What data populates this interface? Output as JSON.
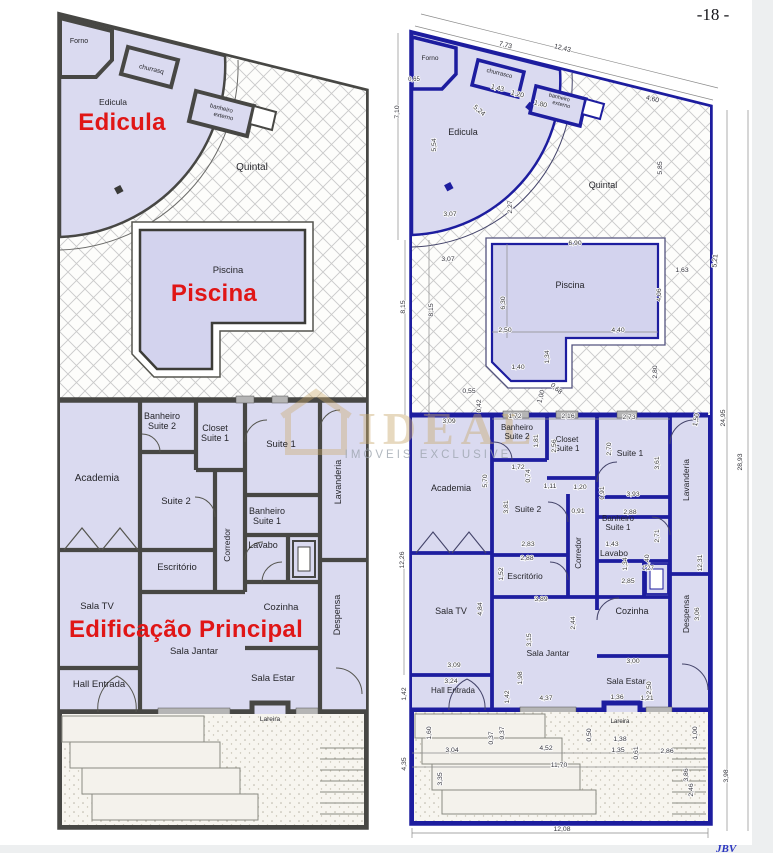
{
  "page": {
    "number_label": "-18 -",
    "footer_logo": "JBV"
  },
  "colors": {
    "red_title": "#e01616",
    "navy_wall": "#1d1d9f",
    "gray_wall": "#474744",
    "lavender_fill": "#dadaf0",
    "pool_fill": "#d3d3ee",
    "hatch_line": "#c9c9c9",
    "watermark_gold": "#c9a96e",
    "watermark_gray": "#9aa2ab"
  },
  "watermark": {
    "brand": "IDEAL",
    "sub": "IMÓVEIS EXCLUSIVE"
  },
  "left_plan": {
    "titles": [
      {
        "t": "Edicula",
        "x": 122,
        "y": 130
      },
      {
        "t": "Piscina",
        "x": 214,
        "y": 301
      },
      {
        "t": "Edificação Principal",
        "x": 186,
        "y": 637
      }
    ],
    "rooms": [
      {
        "t": "Forno",
        "x": 79,
        "y": 43,
        "s": 7
      },
      {
        "t": "churrasq",
        "x": 151,
        "y": 71,
        "r": 14,
        "s": 6.5
      },
      {
        "t": "banheiro",
        "x": 221,
        "y": 110,
        "r": 14,
        "s": 6
      },
      {
        "t": "externo",
        "x": 223,
        "y": 118,
        "r": 14,
        "s": 6
      },
      {
        "t": "Edicula",
        "x": 113,
        "y": 105,
        "s": 8.5
      },
      {
        "t": "Quintal",
        "x": 252,
        "y": 170,
        "s": 10
      },
      {
        "t": "Piscina",
        "x": 228,
        "y": 273,
        "s": 9.5
      },
      {
        "t": "Banheiro",
        "x": 162,
        "y": 419,
        "s": 9
      },
      {
        "t": "Suite 2",
        "x": 162,
        "y": 429,
        "s": 9
      },
      {
        "t": "Closet",
        "x": 215,
        "y": 431,
        "s": 9
      },
      {
        "t": "Suite 1",
        "x": 215,
        "y": 441,
        "s": 9
      },
      {
        "t": "Suite 1",
        "x": 281,
        "y": 447,
        "s": 9.5
      },
      {
        "t": "Academia",
        "x": 97,
        "y": 481,
        "s": 10
      },
      {
        "t": "Suite 2",
        "x": 176,
        "y": 504,
        "s": 9.5
      },
      {
        "t": "Banheiro",
        "x": 267,
        "y": 514,
        "s": 9
      },
      {
        "t": "Suite 1",
        "x": 267,
        "y": 524,
        "s": 9
      },
      {
        "t": "Lavanderia",
        "x": 341,
        "y": 482,
        "r": -90,
        "s": 9
      },
      {
        "t": "Corredor",
        "x": 230,
        "y": 545,
        "r": -90,
        "s": 8.5
      },
      {
        "t": "Lavabo",
        "x": 263,
        "y": 548,
        "s": 9
      },
      {
        "t": "Escritório",
        "x": 177,
        "y": 570,
        "s": 9.5
      },
      {
        "t": "Sala TV",
        "x": 97,
        "y": 609,
        "s": 9.5
      },
      {
        "t": "Cozinha",
        "x": 281,
        "y": 610,
        "s": 9.5
      },
      {
        "t": "Despensa",
        "x": 340,
        "y": 615,
        "r": -90,
        "s": 9
      },
      {
        "t": "Sala Jantar",
        "x": 194,
        "y": 654,
        "s": 9.5
      },
      {
        "t": "Sala Estar",
        "x": 273,
        "y": 681,
        "s": 9.5
      },
      {
        "t": "Hall Entrada",
        "x": 99,
        "y": 687,
        "s": 9.5
      },
      {
        "t": "Lareira",
        "x": 270,
        "y": 721,
        "s": 6.5
      }
    ]
  },
  "right_plan": {
    "rooms": [
      {
        "t": "Forno",
        "x": 430,
        "y": 60,
        "s": 6.5
      },
      {
        "t": "churrasco",
        "x": 499,
        "y": 75,
        "r": 14,
        "s": 6
      },
      {
        "t": "banheiro",
        "x": 559,
        "y": 99,
        "r": 14,
        "s": 5.5
      },
      {
        "t": "externo",
        "x": 561,
        "y": 106,
        "r": 14,
        "s": 5.5
      },
      {
        "t": "Edicula",
        "x": 463,
        "y": 135,
        "s": 9
      },
      {
        "t": "Quintal",
        "x": 603,
        "y": 188,
        "s": 9
      },
      {
        "t": "Piscina",
        "x": 570,
        "y": 288,
        "s": 9
      },
      {
        "t": "Banheiro",
        "x": 517,
        "y": 430,
        "s": 8
      },
      {
        "t": "Suite 2",
        "x": 517,
        "y": 439,
        "s": 8
      },
      {
        "t": "Closet",
        "x": 567,
        "y": 442,
        "s": 8
      },
      {
        "t": "Suite 1",
        "x": 567,
        "y": 451,
        "s": 8
      },
      {
        "t": "Suite 1",
        "x": 630,
        "y": 456,
        "s": 8.5
      },
      {
        "t": "Academia",
        "x": 451,
        "y": 491,
        "s": 9
      },
      {
        "t": "Suite 2",
        "x": 528,
        "y": 512,
        "s": 8.5
      },
      {
        "t": "Banheiro",
        "x": 618,
        "y": 521,
        "s": 8
      },
      {
        "t": "Suite 1",
        "x": 618,
        "y": 530,
        "s": 8
      },
      {
        "t": "Lavanderia",
        "x": 689,
        "y": 480,
        "r": -90,
        "s": 8.5
      },
      {
        "t": "Corredor",
        "x": 581,
        "y": 553,
        "r": -90,
        "s": 8
      },
      {
        "t": "Lavabo",
        "x": 614,
        "y": 556,
        "s": 8.5
      },
      {
        "t": "Escritório",
        "x": 525,
        "y": 579,
        "s": 8.5
      },
      {
        "t": "Sala TV",
        "x": 451,
        "y": 614,
        "s": 9
      },
      {
        "t": "Cozinha",
        "x": 632,
        "y": 614,
        "s": 9
      },
      {
        "t": "Despensa",
        "x": 689,
        "y": 614,
        "r": -90,
        "s": 8.5
      },
      {
        "t": "Sala Jantar",
        "x": 548,
        "y": 656,
        "s": 8.5
      },
      {
        "t": "Sala Estar",
        "x": 626,
        "y": 684,
        "s": 8.5
      },
      {
        "t": "Hall Entrada",
        "x": 453,
        "y": 693,
        "s": 8
      },
      {
        "t": "Lareira",
        "x": 620,
        "y": 723,
        "s": 6
      }
    ],
    "dims": [
      {
        "t": "7,73",
        "x": 505,
        "y": 47,
        "r": 14
      },
      {
        "t": "12,43",
        "x": 562,
        "y": 50,
        "r": 14
      },
      {
        "t": "0,65",
        "x": 414,
        "y": 81,
        "s": 6
      },
      {
        "t": "1,43",
        "x": 497,
        "y": 90,
        "r": 14
      },
      {
        "t": "1,20",
        "x": 517,
        "y": 96,
        "r": 14
      },
      {
        "t": "1,80",
        "x": 540,
        "y": 106,
        "r": 14
      },
      {
        "t": "4,60",
        "x": 652,
        "y": 101,
        "r": 14
      },
      {
        "t": "7,10",
        "x": 399,
        "y": 112,
        "r": -90
      },
      {
        "t": "5,54",
        "x": 436,
        "y": 145,
        "r": -90
      },
      {
        "t": "5,24",
        "x": 478,
        "y": 112,
        "r": 40
      },
      {
        "t": "5,85",
        "x": 662,
        "y": 168,
        "r": -90
      },
      {
        "t": "2,27",
        "x": 512,
        "y": 207,
        "r": -90
      },
      {
        "t": "3,07",
        "x": 450,
        "y": 216
      },
      {
        "t": "6,90",
        "x": 575,
        "y": 245
      },
      {
        "t": "3,07",
        "x": 448,
        "y": 261
      },
      {
        "t": "1,63",
        "x": 682,
        "y": 272
      },
      {
        "t": "5,21",
        "x": 717,
        "y": 261,
        "r": -85
      },
      {
        "t": "6,30",
        "x": 505,
        "y": 303,
        "r": -90
      },
      {
        "t": "4,06",
        "x": 661,
        "y": 295,
        "r": -90
      },
      {
        "t": "8,15",
        "x": 405,
        "y": 307,
        "r": -90
      },
      {
        "t": "8,15",
        "x": 433,
        "y": 310,
        "r": -90
      },
      {
        "t": "2,50",
        "x": 505,
        "y": 332
      },
      {
        "t": "4,40",
        "x": 618,
        "y": 332
      },
      {
        "t": "1,40",
        "x": 518,
        "y": 369
      },
      {
        "t": "1,34",
        "x": 549,
        "y": 357,
        "r": -90
      },
      {
        "t": "2,80",
        "x": 657,
        "y": 372,
        "r": -90
      },
      {
        "t": "0,55",
        "x": 469,
        "y": 393
      },
      {
        "t": "0,42",
        "x": 481,
        "y": 406,
        "r": -90
      },
      {
        "t": "1,00",
        "x": 543,
        "y": 397,
        "r": -75
      },
      {
        "t": "0,68",
        "x": 555,
        "y": 390,
        "r": 42
      },
      {
        "t": "24,95",
        "x": 725,
        "y": 418,
        "r": -90
      },
      {
        "t": "28,93",
        "x": 742,
        "y": 462,
        "r": -90
      },
      {
        "t": "3,09",
        "x": 449,
        "y": 423
      },
      {
        "t": "1,72",
        "x": 515,
        "y": 418
      },
      {
        "t": "2,16",
        "x": 568,
        "y": 418
      },
      {
        "t": "2,73",
        "x": 629,
        "y": 419
      },
      {
        "t": "1,50",
        "x": 698,
        "y": 420,
        "r": -80
      },
      {
        "t": "1,81",
        "x": 538,
        "y": 441,
        "r": -90
      },
      {
        "t": "2,56",
        "x": 556,
        "y": 446,
        "r": -90
      },
      {
        "t": "2,70",
        "x": 611,
        "y": 449,
        "r": -90
      },
      {
        "t": "3,61",
        "x": 659,
        "y": 463,
        "r": -90
      },
      {
        "t": "1,72",
        "x": 518,
        "y": 469
      },
      {
        "t": "0,74",
        "x": 530,
        "y": 476,
        "r": -90
      },
      {
        "t": "5,70",
        "x": 487,
        "y": 481,
        "r": -90
      },
      {
        "t": "1,11",
        "x": 550,
        "y": 488
      },
      {
        "t": "1,20",
        "x": 580,
        "y": 489
      },
      {
        "t": "0,91",
        "x": 604,
        "y": 493,
        "r": -90
      },
      {
        "t": "3,93",
        "x": 633,
        "y": 496
      },
      {
        "t": "3,81",
        "x": 508,
        "y": 507,
        "r": -90
      },
      {
        "t": "0,91",
        "x": 578,
        "y": 513
      },
      {
        "t": "2,88",
        "x": 630,
        "y": 514
      },
      {
        "t": "2,71",
        "x": 659,
        "y": 536,
        "r": -90
      },
      {
        "t": "2,83",
        "x": 528,
        "y": 546
      },
      {
        "t": "2,88",
        "x": 527,
        "y": 560
      },
      {
        "t": "1,43",
        "x": 612,
        "y": 546
      },
      {
        "t": "1,40",
        "x": 649,
        "y": 561,
        "r": -90
      },
      {
        "t": "1,34",
        "x": 627,
        "y": 564,
        "r": -90
      },
      {
        "t": "1,27",
        "x": 648,
        "y": 570,
        "s": 6
      },
      {
        "t": "1,52",
        "x": 503,
        "y": 574,
        "r": -90
      },
      {
        "t": "2,85",
        "x": 628,
        "y": 583
      },
      {
        "t": "3,89",
        "x": 541,
        "y": 601
      },
      {
        "t": "4,84",
        "x": 482,
        "y": 609,
        "r": -90
      },
      {
        "t": "12,26",
        "x": 404,
        "y": 560,
        "r": -90
      },
      {
        "t": "2,44",
        "x": 575,
        "y": 623,
        "r": -90
      },
      {
        "t": "3,06",
        "x": 699,
        "y": 614,
        "r": -90
      },
      {
        "t": "12,31",
        "x": 702,
        "y": 563,
        "r": -90
      },
      {
        "t": "3,15",
        "x": 531,
        "y": 640,
        "r": -90
      },
      {
        "t": "1,98",
        "x": 522,
        "y": 678,
        "r": -90
      },
      {
        "t": "3,09",
        "x": 454,
        "y": 667
      },
      {
        "t": "3,00",
        "x": 633,
        "y": 663
      },
      {
        "t": "3,24",
        "x": 451,
        "y": 683
      },
      {
        "t": "1,42",
        "x": 406,
        "y": 694,
        "r": -90
      },
      {
        "t": "1,42",
        "x": 509,
        "y": 697,
        "r": -90
      },
      {
        "t": "2,50",
        "x": 651,
        "y": 688,
        "r": -90
      },
      {
        "t": "4,37",
        "x": 546,
        "y": 700
      },
      {
        "t": "1,36",
        "x": 617,
        "y": 699
      },
      {
        "t": "1,21",
        "x": 647,
        "y": 700
      },
      {
        "t": "1,60",
        "x": 431,
        "y": 733,
        "r": -90
      },
      {
        "t": "0,37",
        "x": 493,
        "y": 738,
        "r": -90
      },
      {
        "t": "0,37",
        "x": 504,
        "y": 733,
        "r": -90
      },
      {
        "t": "0,50",
        "x": 591,
        "y": 735,
        "r": -90
      },
      {
        "t": "1,38",
        "x": 620,
        "y": 741
      },
      {
        "t": "1,35",
        "x": 618,
        "y": 752
      },
      {
        "t": "0,61",
        "x": 638,
        "y": 753,
        "r": -90
      },
      {
        "t": "2,86",
        "x": 667,
        "y": 753
      },
      {
        "t": "1,00",
        "x": 697,
        "y": 733,
        "r": -90
      },
      {
        "t": "3,04",
        "x": 452,
        "y": 752
      },
      {
        "t": "4,52",
        "x": 546,
        "y": 750
      },
      {
        "t": "11,70",
        "x": 559,
        "y": 767
      },
      {
        "t": "4,35",
        "x": 406,
        "y": 764,
        "r": -90
      },
      {
        "t": "3,35",
        "x": 442,
        "y": 779,
        "r": -90
      },
      {
        "t": "3,86",
        "x": 688,
        "y": 775,
        "r": -90
      },
      {
        "t": "2,46",
        "x": 693,
        "y": 790,
        "r": -90
      },
      {
        "t": "3,98",
        "x": 728,
        "y": 776,
        "r": -90
      },
      {
        "t": "12,08",
        "x": 562,
        "y": 831
      }
    ]
  }
}
